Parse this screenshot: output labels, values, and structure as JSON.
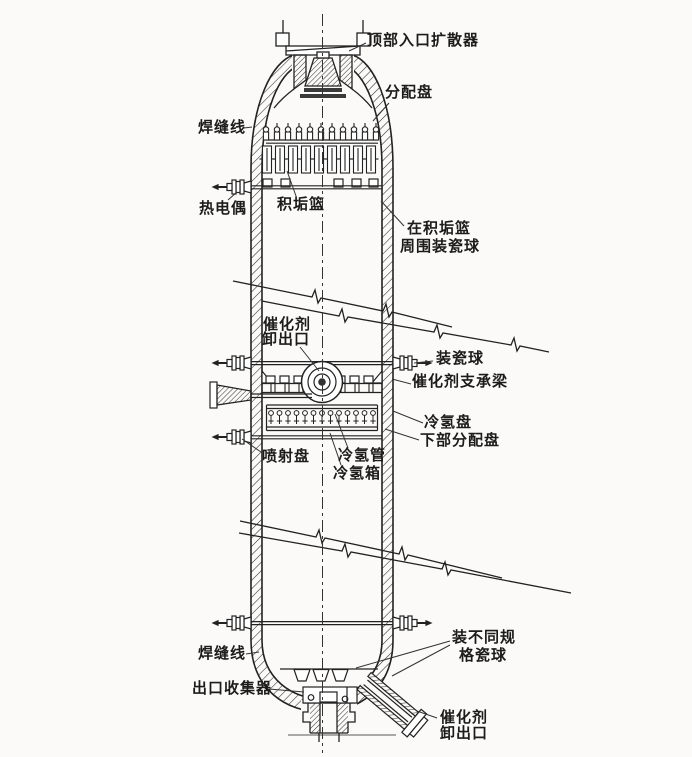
{
  "colors": {
    "ink": "#222222",
    "paper": "#fbfaf8"
  },
  "labels": {
    "top_inlet_diffuser": "顶部入口扩散器",
    "distribution_tray": "分配盘",
    "weld_line_top": "焊缝线",
    "thermocouple": "热电偶",
    "scale_basket": "积垢篮",
    "balls_around_basket_line1": "在积垢篮",
    "balls_around_basket_line2": "周围装瓷球",
    "catalyst_unload_mid_line1": "催化剂",
    "catalyst_unload_mid_line2": "卸出口",
    "load_ceramic_balls": "装瓷球",
    "catalyst_support_beam": "催化剂支承梁",
    "cold_hydrogen_tray": "冷氢盘",
    "lower_distribution_tray": "下部分配盘",
    "spray_tray": "喷射盘",
    "cold_hydrogen_pipe": "冷氢管",
    "cold_hydrogen_box": "冷氢箱",
    "weld_line_bottom": "焊缝线",
    "different_spec_balls_line1": "装不同规",
    "different_spec_balls_line2": "格瓷球",
    "outlet_collector": "出口收集器",
    "catalyst_unload_bottom_line1": "催化剂",
    "catalyst_unload_bottom_line2": "卸出口"
  }
}
